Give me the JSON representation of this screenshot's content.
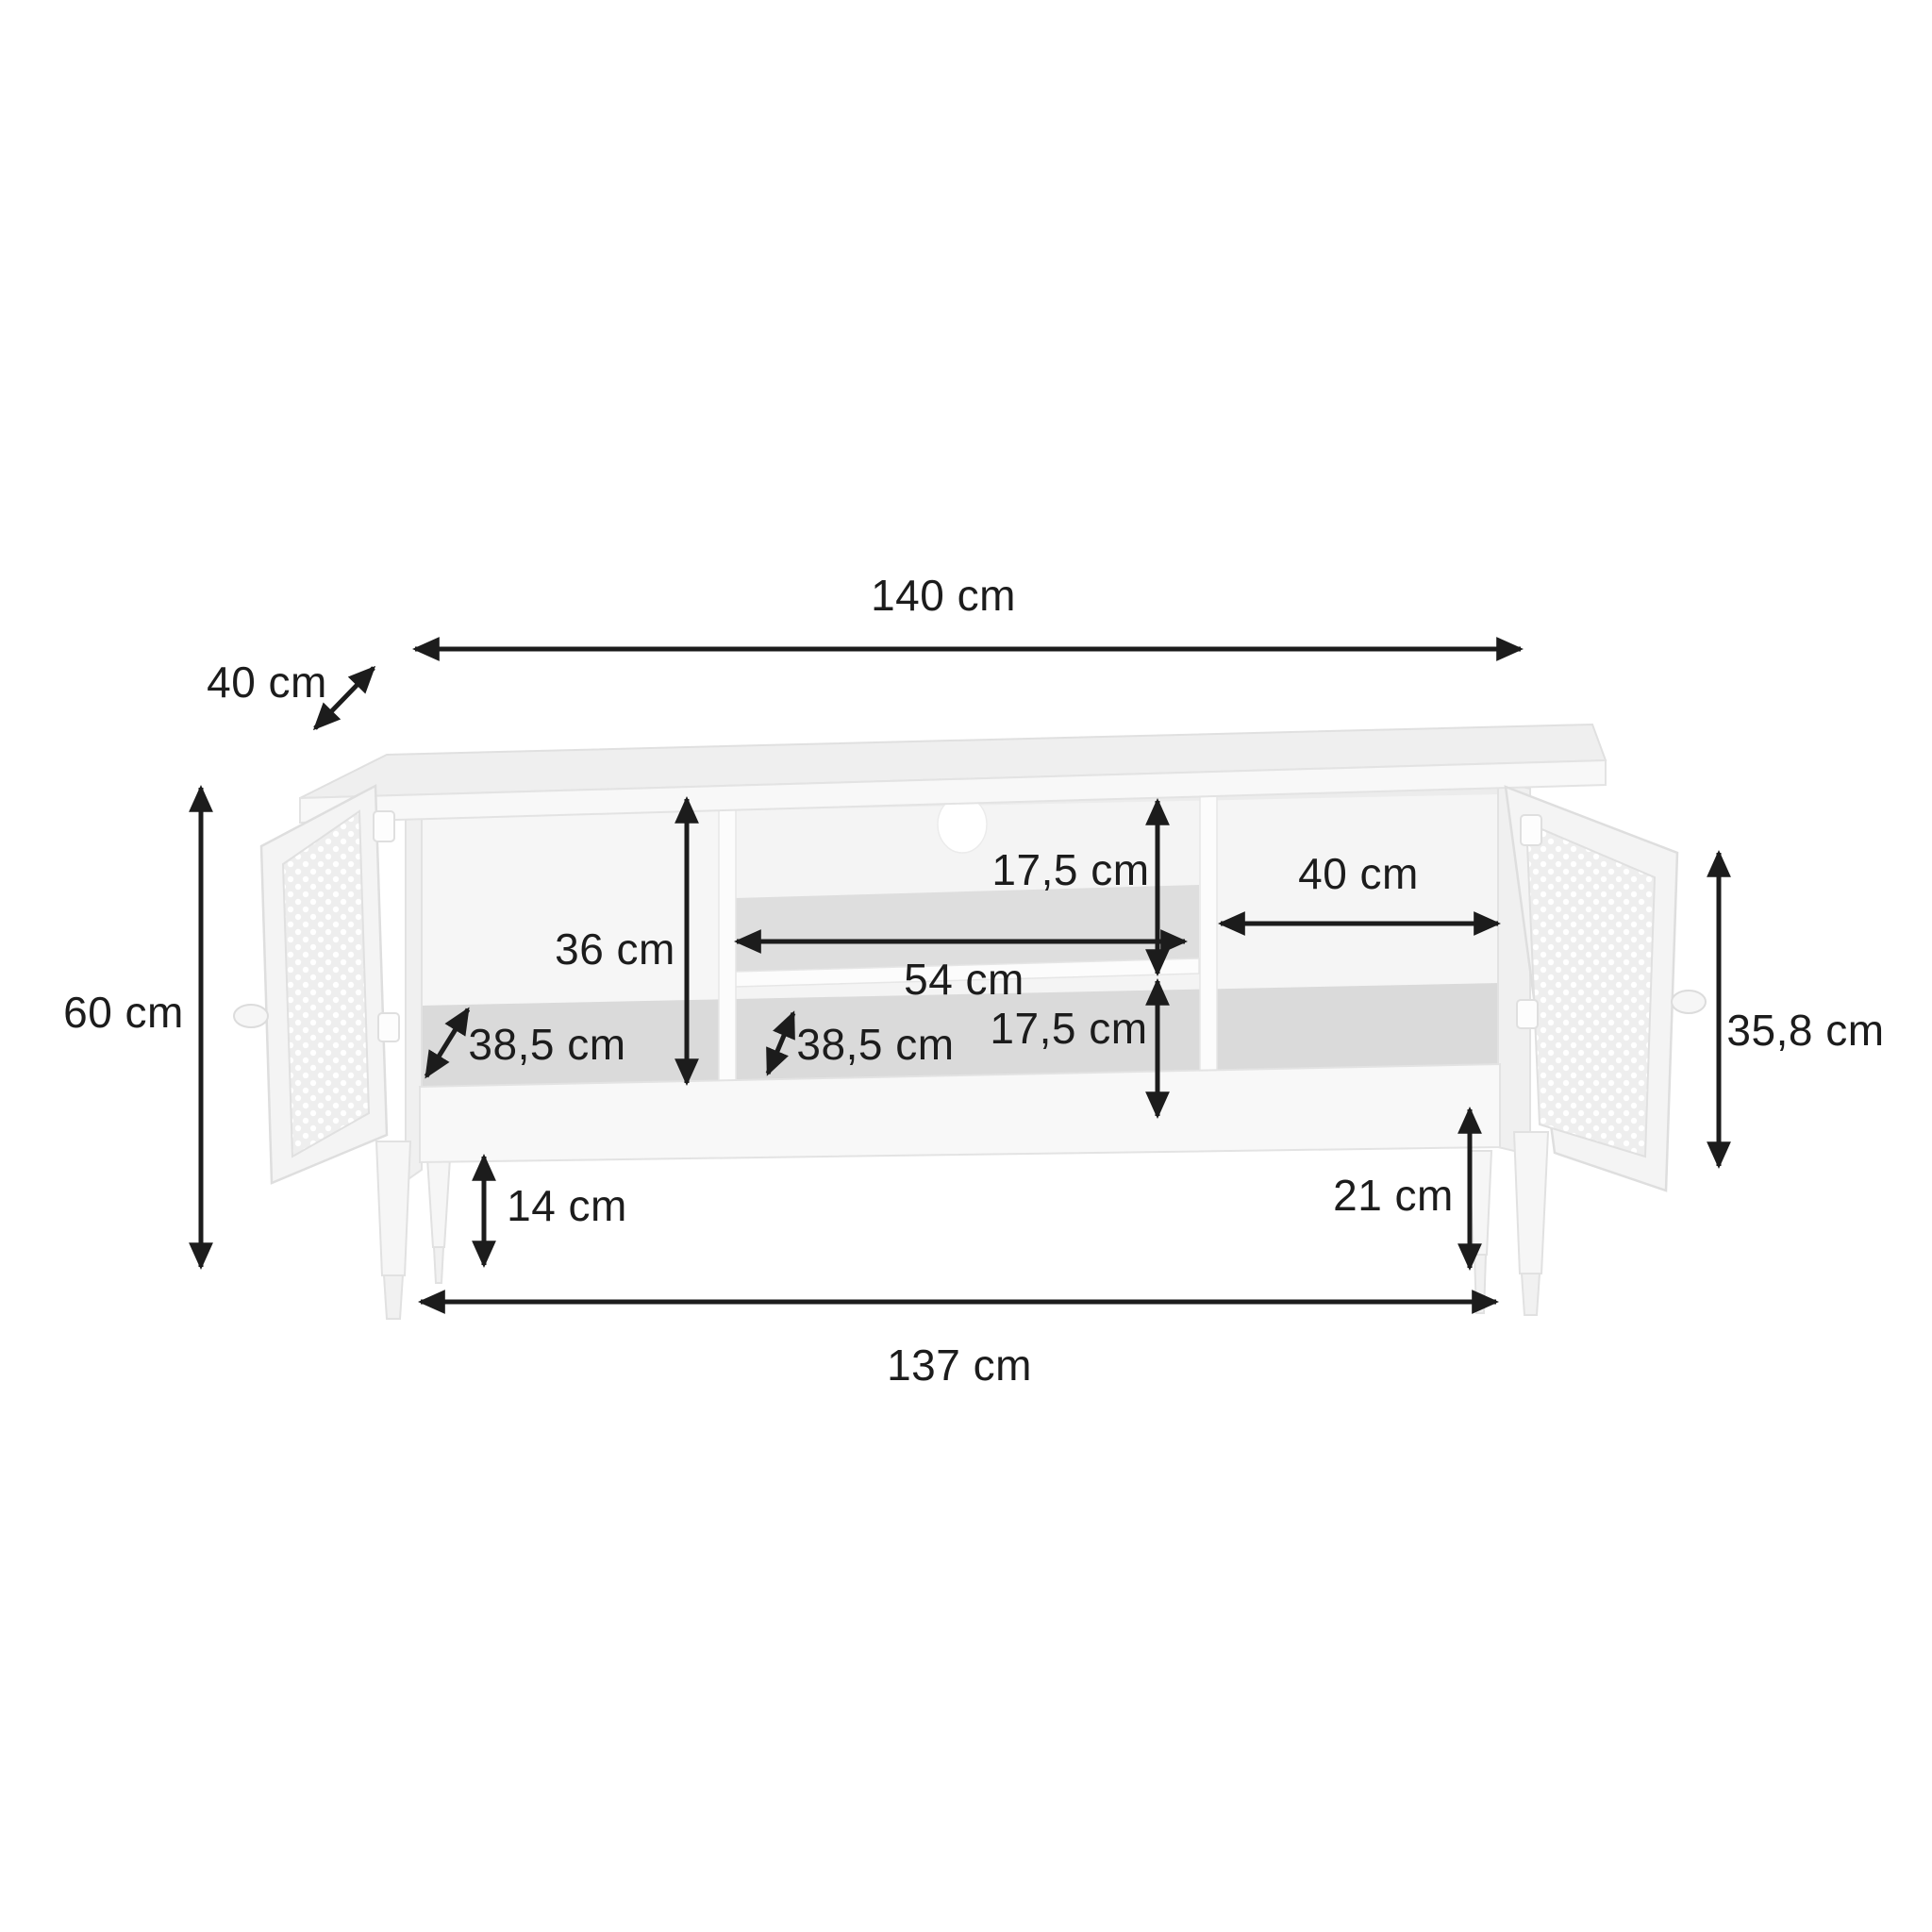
{
  "diagram": {
    "figure": "tv-stand-dimensions",
    "unit": "cm",
    "colors": {
      "background": "#ffffff",
      "annotation": "#1c1c1c",
      "furniture_light": "#f8f8f8",
      "furniture_mid": "#efefef",
      "furniture_shadow": "#dadada",
      "furniture_stroke": "#e2e2e2"
    },
    "dimensions": {
      "overall_width": {
        "label": "140 cm"
      },
      "overall_depth": {
        "label": "40 cm"
      },
      "overall_height": {
        "label": "60 cm"
      },
      "interior_height": {
        "label": "36 cm"
      },
      "top_niche_height": {
        "label": "17,5 cm"
      },
      "center_niche_width": {
        "label": "54 cm"
      },
      "right_compartment_width": {
        "label": "40 cm"
      },
      "bottom_niche_height": {
        "label": "17,5 cm"
      },
      "left_compartment_depth": {
        "label": "38,5 cm"
      },
      "center_compartment_depth": {
        "label": "38,5 cm"
      },
      "left_floor_clearance": {
        "label": "14 cm"
      },
      "right_floor_clearance": {
        "label": "21 cm"
      },
      "door_height": {
        "label": "35,8 cm"
      },
      "base_width": {
        "label": "137 cm"
      }
    }
  }
}
